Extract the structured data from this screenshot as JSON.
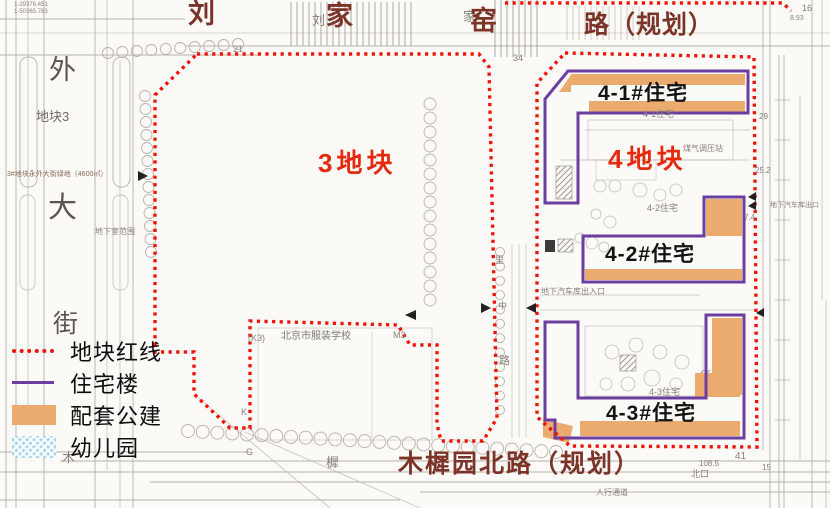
{
  "colors": {
    "plot_redline": "#ee1408",
    "residential_purple": "#6b3fa0",
    "public_orange": "#ebaa6e",
    "kindergarten_blue": "#a6d8ef",
    "plot_label_red": "#e5290f",
    "road_name_maroon": "#7c3328"
  },
  "roads": {
    "top": {
      "char1": "刘",
      "char2": "家",
      "char3": "窑",
      "suffix": "路（规划）"
    },
    "bottom": "木樨园北路（规划）",
    "left_street": [
      "外",
      "大",
      "街"
    ]
  },
  "plots": {
    "plot3": "3地块",
    "plot4": "4地块"
  },
  "buildings": {
    "b41": "4-1#住宅",
    "b42": "4-2#住宅",
    "b43": "4-3#住宅"
  },
  "legend": {
    "items": [
      {
        "label": "地块红线",
        "swatch": "red-dotted"
      },
      {
        "label": "住宅楼",
        "swatch": "purple-line"
      },
      {
        "label": "配套公建",
        "swatch": "orange-fill"
      },
      {
        "label": "幼儿园",
        "swatch": "blue-hatch"
      }
    ]
  },
  "map_texts": [
    {
      "t": "1-29376.451",
      "x": 14,
      "y": 2,
      "fs": 6
    },
    {
      "t": "1-50365.783",
      "x": 14,
      "y": 9,
      "fs": 6
    },
    {
      "t": "地块3",
      "x": 36,
      "y": 110,
      "fs": 13,
      "c": "#6e6a64"
    },
    {
      "t": "3#地块永外大街绿地（4600㎡）",
      "x": 7,
      "y": 171,
      "fs": 7,
      "c": "#8a6a58"
    },
    {
      "t": "地下室范围",
      "x": 95,
      "y": 228,
      "fs": 8
    },
    {
      "t": "北京市服装学校",
      "x": 281,
      "y": 332,
      "fs": 10,
      "c": "#7d7a73"
    },
    {
      "t": "(K3)",
      "x": 248,
      "y": 334,
      "fs": 9
    },
    {
      "t": "M3",
      "x": 393,
      "y": 331,
      "fs": 9
    },
    {
      "t": "K",
      "x": 241,
      "y": 408,
      "fs": 9
    },
    {
      "t": "地下汽车库出入口",
      "x": 541,
      "y": 288,
      "fs": 8
    },
    {
      "t": "人行通道",
      "x": 596,
      "y": 489,
      "fs": 8
    },
    {
      "t": "4-1住宅",
      "x": 643,
      "y": 110,
      "fs": 9
    },
    {
      "t": "4-2住宅",
      "x": 647,
      "y": 204,
      "fs": 9
    },
    {
      "t": "4-3住宅",
      "x": 649,
      "y": 388,
      "fs": 9
    },
    {
      "t": "煤气调压站",
      "x": 683,
      "y": 145,
      "fs": 8
    },
    {
      "t": "21",
      "x": 233,
      "y": 45,
      "fs": 9
    },
    {
      "t": "34",
      "x": 513,
      "y": 54,
      "fs": 9
    },
    {
      "t": "41",
      "x": 735,
      "y": 452,
      "fs": 10
    },
    {
      "t": "108.5",
      "x": 699,
      "y": 460,
      "fs": 8
    },
    {
      "t": "15",
      "x": 762,
      "y": 464,
      "fs": 8
    },
    {
      "t": "北口",
      "x": 691,
      "y": 470,
      "fs": 9
    },
    {
      "t": "G",
      "x": 246,
      "y": 448,
      "fs": 9
    },
    {
      "t": "木",
      "x": 62,
      "y": 451,
      "fs": 13
    },
    {
      "t": "樨",
      "x": 326,
      "y": 456,
      "fs": 13
    },
    {
      "t": "刘",
      "x": 312,
      "y": 14,
      "fs": 13
    },
    {
      "t": "家",
      "x": 463,
      "y": 10,
      "fs": 13
    },
    {
      "t": "里",
      "x": 495,
      "y": 256,
      "fs": 9
    },
    {
      "t": "中",
      "x": 498,
      "y": 302,
      "fs": 9
    },
    {
      "t": "路",
      "x": 499,
      "y": 356,
      "fs": 11
    },
    {
      "t": "29",
      "x": 759,
      "y": 113,
      "fs": 8
    },
    {
      "t": "25.2",
      "x": 755,
      "y": 167,
      "fs": 8
    },
    {
      "t": "7.4",
      "x": 744,
      "y": 214,
      "fs": 8
    },
    {
      "t": "16",
      "x": 802,
      "y": 4,
      "fs": 9
    },
    {
      "t": "8.93",
      "x": 790,
      "y": 15,
      "fs": 7
    },
    {
      "t": "地下汽车库出口",
      "x": 770,
      "y": 202,
      "fs": 7
    }
  ]
}
